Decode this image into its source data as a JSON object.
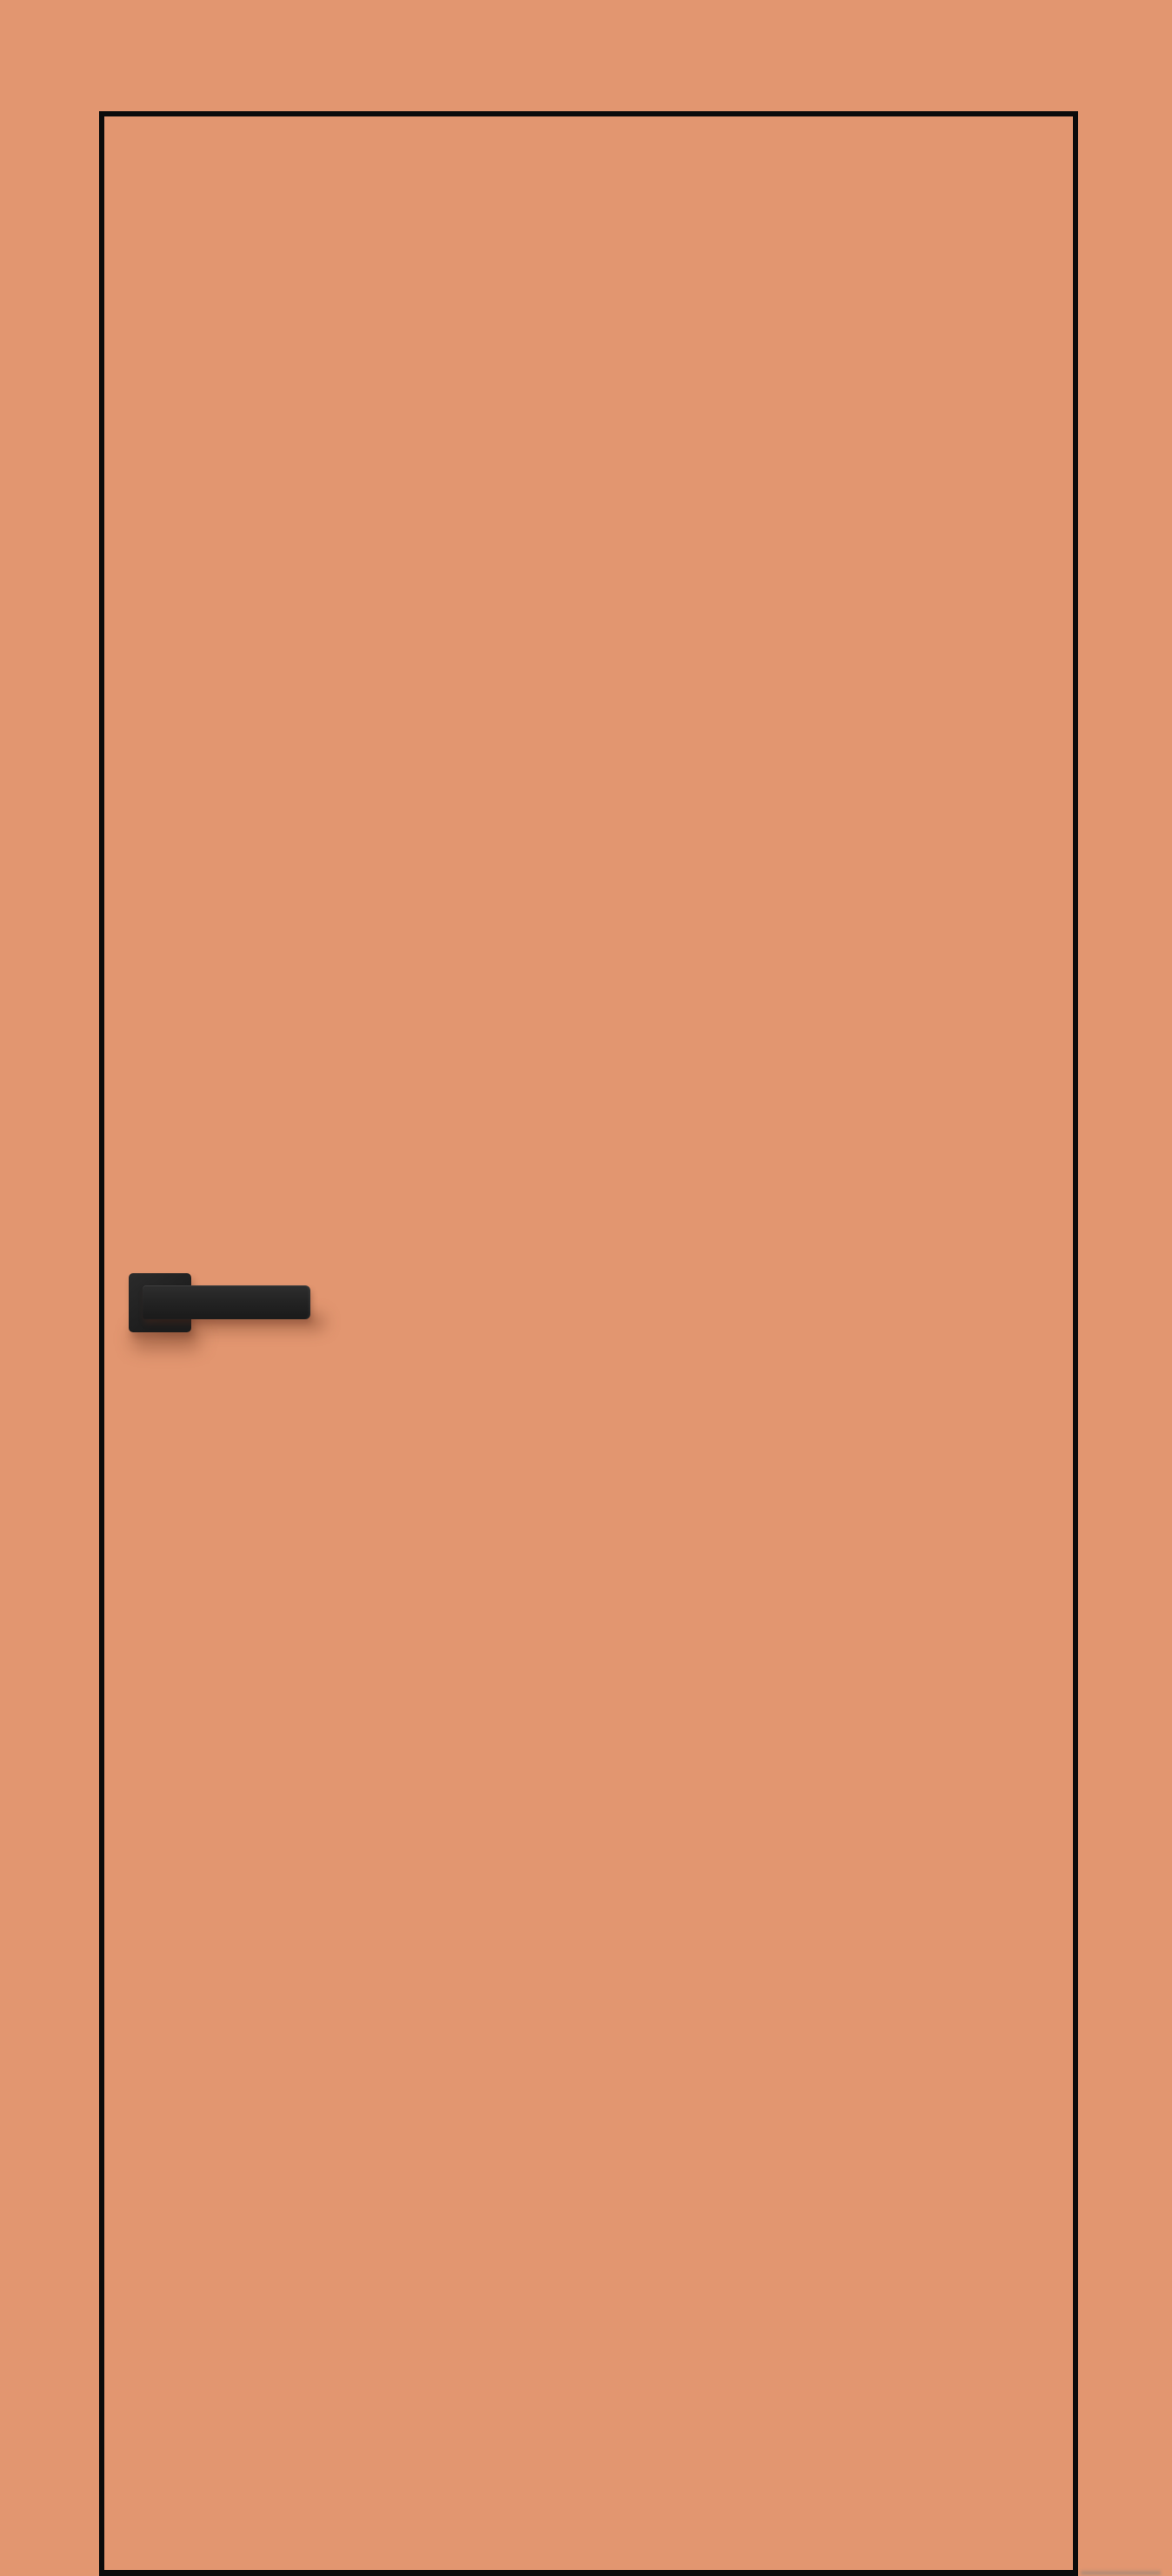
{
  "scene": {
    "subject": "flat-slab-door-with-lever-handle",
    "handle_style": "square-rosette-straight-lever",
    "handle_side": "left"
  },
  "colors": {
    "bg": "#E29670",
    "outline": "#0B0B0B",
    "rosette-a": "#2B2B2B",
    "rosette-b": "#1C1C1C",
    "lever-a": "#2E2E2E",
    "lever-b": "#1A1A1A",
    "shadow": "rgba(92,44,26,0.40)",
    "smudge": "rgba(142,131,124,0.55)"
  }
}
